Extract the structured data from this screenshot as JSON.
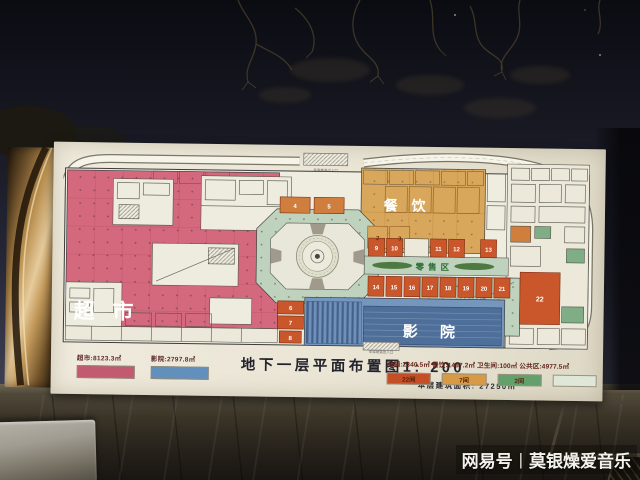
{
  "poster": {
    "title": "地下一层平面布置图1: 200",
    "subtitle": "本层建筑面积: 27250㎡",
    "legend_left": [
      {
        "label": "超市:8123.3㎡",
        "color": "#c25a70"
      },
      {
        "label": "影院:2797.8㎡",
        "color": "#6290bc"
      }
    ],
    "legend_right_line": "商铺:2340.5㎡ 餐饮:1487.2㎡ 卫生间:100㎡ 公共区:4977.5㎡",
    "legend_swatches": [
      {
        "label": "22间",
        "color": "#c44f26"
      },
      {
        "label": "7间",
        "color": "#d89a45"
      },
      {
        "label": "2间",
        "color": "#63a06b"
      },
      {
        "label": "",
        "color": "#dfe7d8"
      }
    ]
  },
  "plan": {
    "areas": {
      "supermarket": "超 市",
      "dining": "餐 饮",
      "cinema": "影 院",
      "retail": "零售区"
    },
    "ramp_label": "车库坡道出入口",
    "units": {
      "atrium_top": [
        "4",
        "5"
      ],
      "dining_pair": [
        "2",
        "3"
      ],
      "center_stack": [
        "6",
        "7",
        "8"
      ],
      "row_a": [
        "9",
        "10",
        "11",
        "12",
        "13"
      ],
      "row_b": [
        "14",
        "15",
        "16",
        "17",
        "18",
        "19",
        "20",
        "21"
      ],
      "big_unit": "22"
    },
    "colors": {
      "supermarket": "#d4697d",
      "dining": "#d9a75b",
      "shops": "#c9572b",
      "public_green": "#bfd2bd",
      "cinema_light": "#7596bd",
      "cinema_dark": "#4e6f9a",
      "paper": "#ece8db"
    }
  },
  "watermark": {
    "brand": "网易号",
    "separator": "|",
    "account": "莫银燥爱音乐"
  }
}
